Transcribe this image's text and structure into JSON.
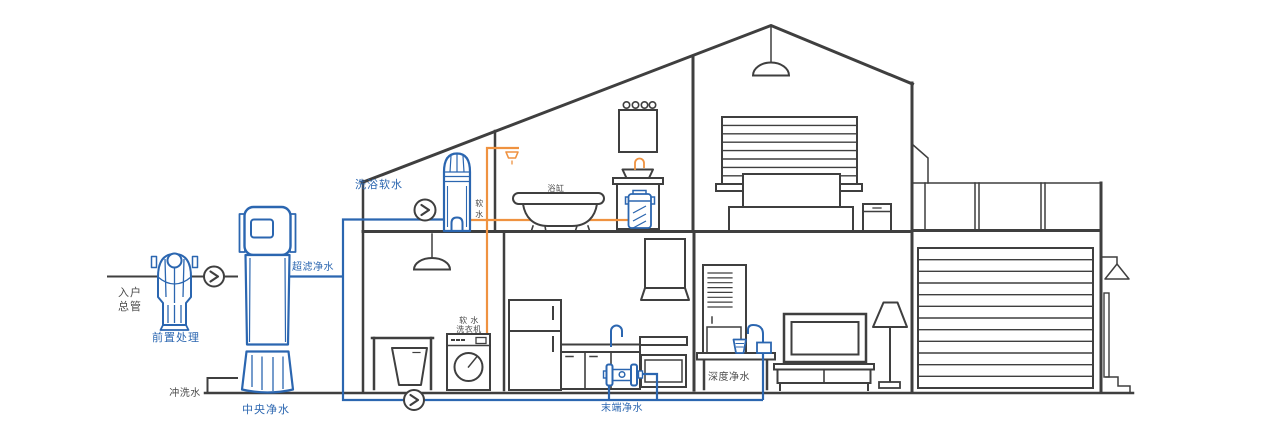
{
  "colors": {
    "pipe_blue": "#2b66b0",
    "pipe_orange": "#ef9240",
    "structure_line": "#3f3f3f",
    "text_dark": "#4a4a4a"
  },
  "labels": {
    "entry_main_line1": "入户",
    "entry_main_line2": "总管",
    "pre_treatment": "前置处理",
    "flush_water": "冲洗水",
    "central_purifier": "中央净水",
    "ultrafiltration": "超滤净水",
    "bath_softener": "洗浴软水",
    "soft_water_char1": "软",
    "soft_water_char2": "水",
    "bathtub": "浴缸",
    "washer_line1": "软 水",
    "washer_line2": "洗衣机",
    "terminal_purifier": "末端净水",
    "deep_purifier": "深度净水"
  }
}
